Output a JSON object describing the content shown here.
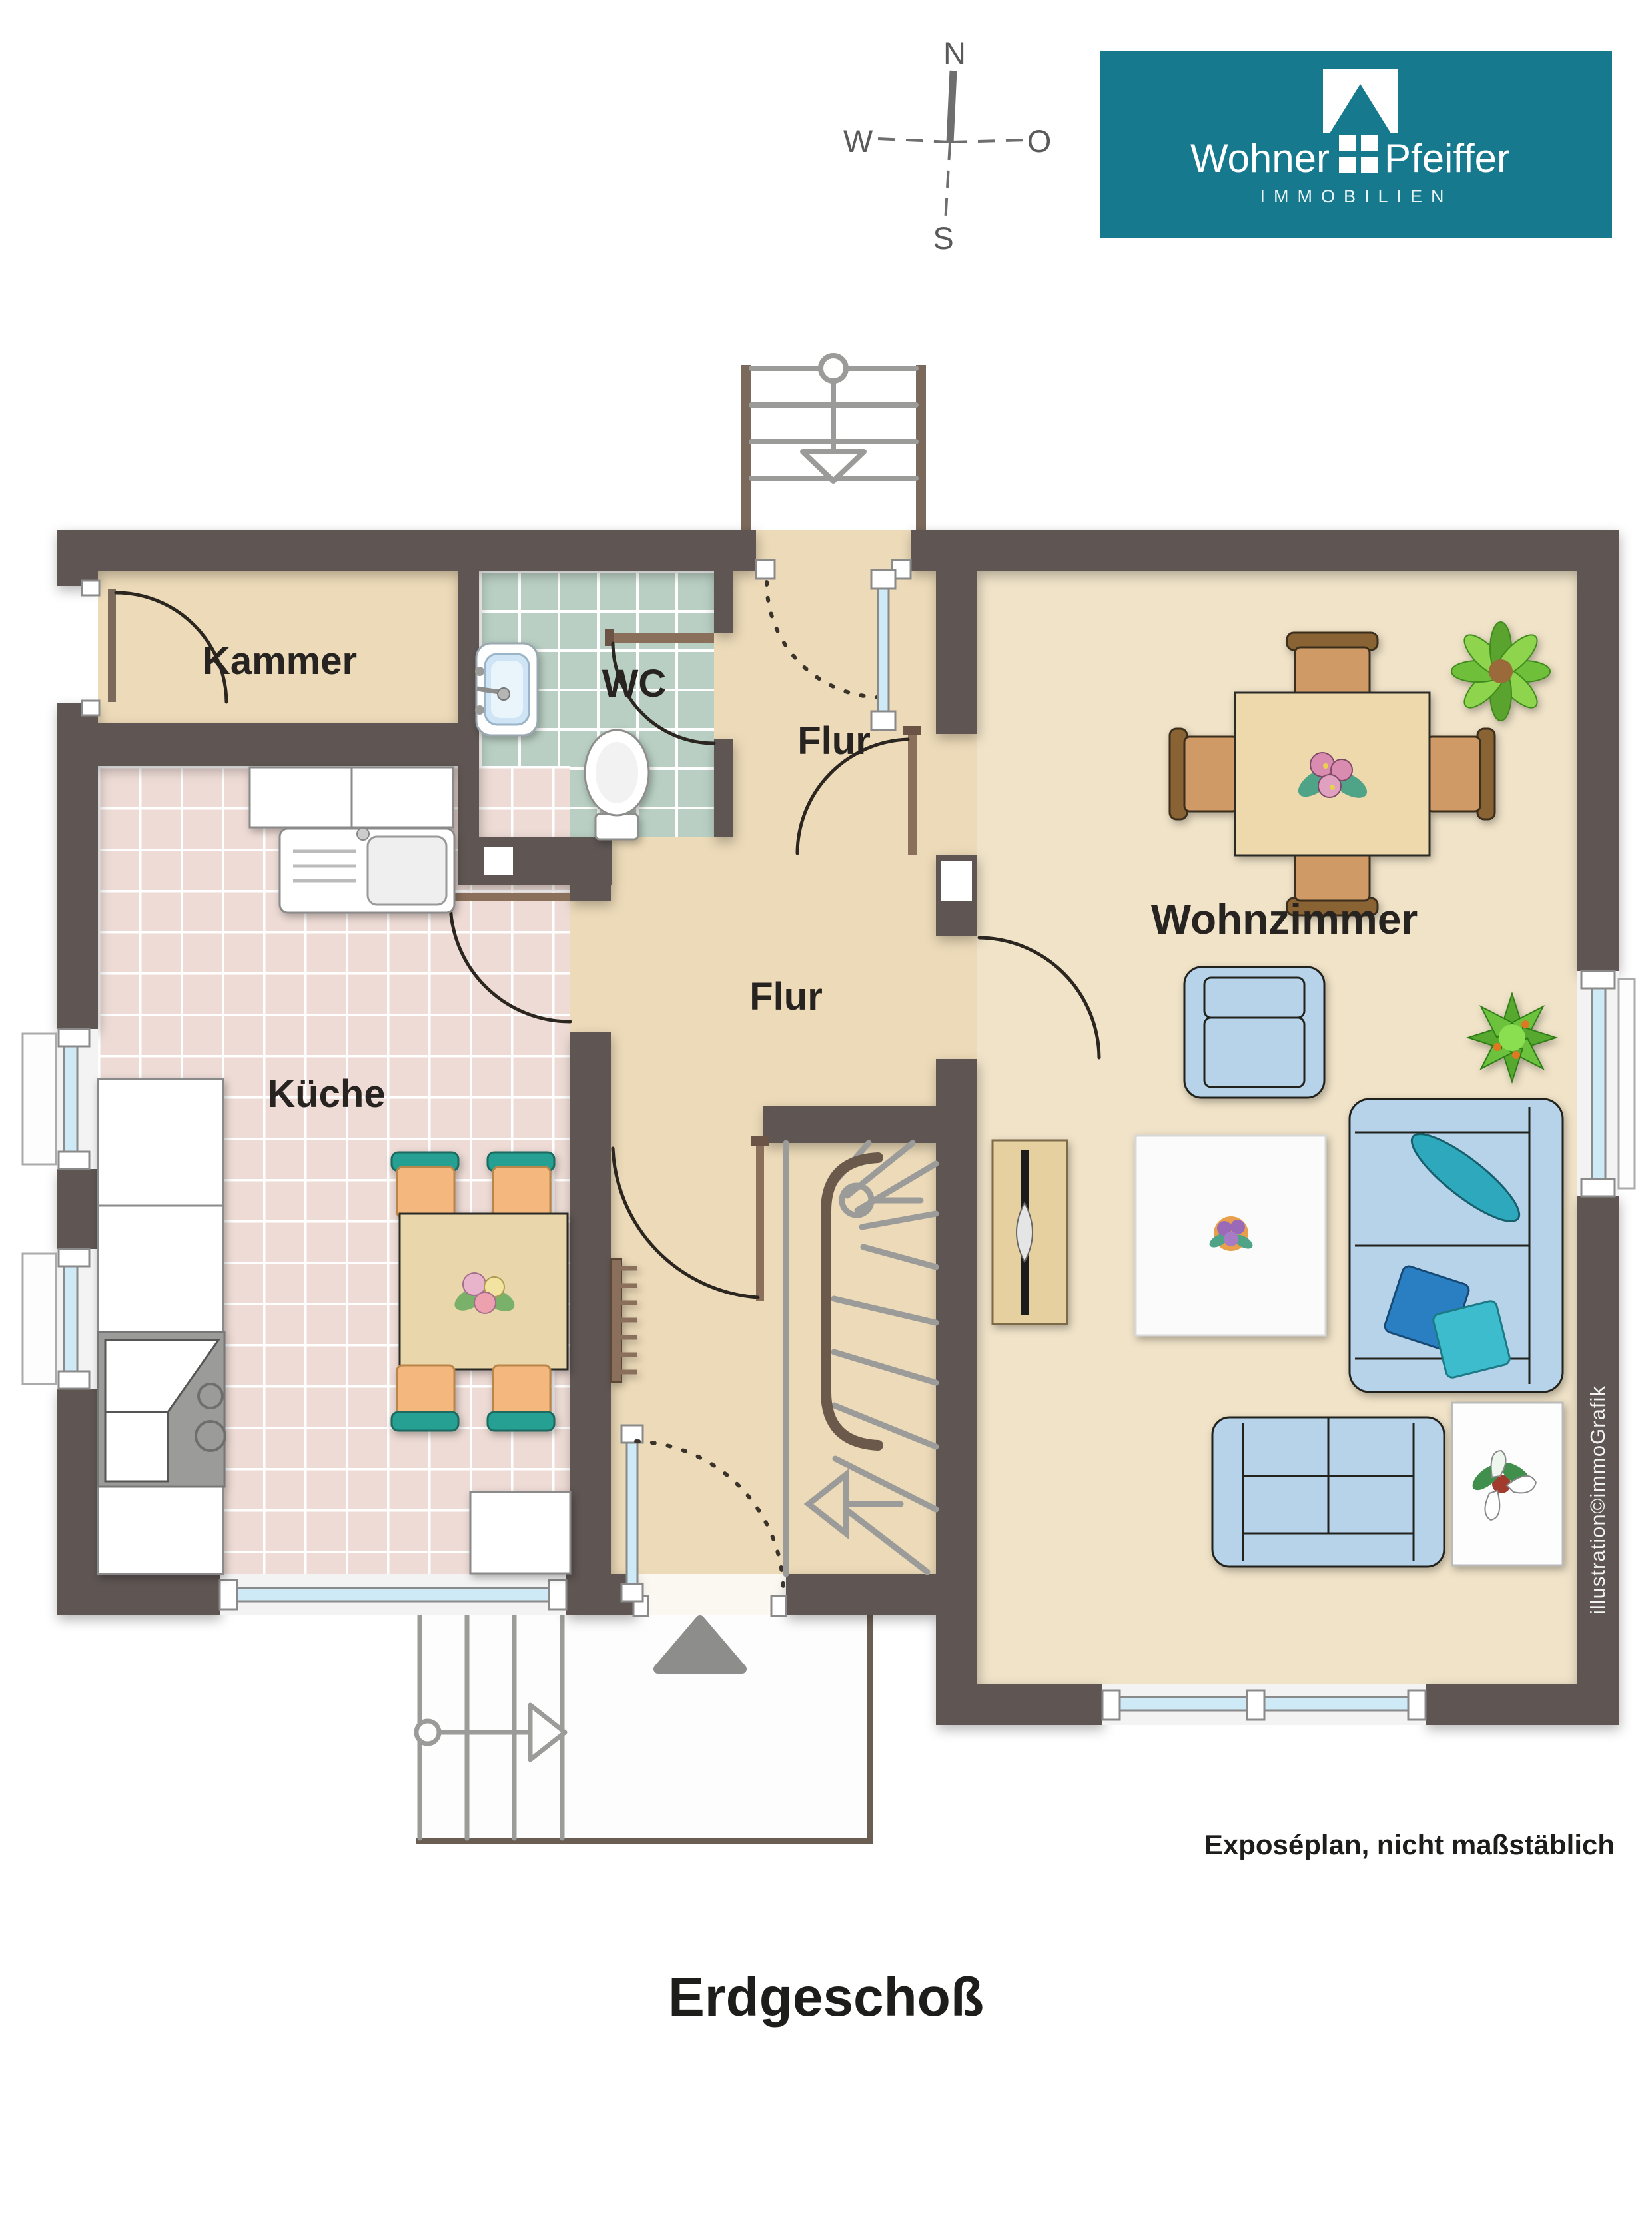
{
  "compass": {
    "north": "N",
    "south": "S",
    "west": "W",
    "east": "O"
  },
  "logo": {
    "name_first": "Wohner",
    "name_second": "Pfeiffer",
    "tagline": "IMMOBILIEN",
    "brand_color": "#17798e"
  },
  "plan": {
    "rooms": [
      {
        "id": "kammer",
        "label": "Kammer"
      },
      {
        "id": "wc",
        "label": "WC"
      },
      {
        "id": "flur-top",
        "label": "Flur"
      },
      {
        "id": "flur",
        "label": "Flur"
      },
      {
        "id": "kueche",
        "label": "Küche"
      },
      {
        "id": "wohnzimmer",
        "label": "Wohnzimmer"
      }
    ],
    "credit": "illustration©immoGrafik",
    "colors": {
      "wall": "#5e5752",
      "floor_hall": "#ecdab8",
      "floor_living": "#f0e3c8",
      "tile_kitchen": "#eedbd5",
      "tile_wc": "#b9cfc3",
      "window_glass": "#cdeaf6",
      "stair_gray": "#9b9b99",
      "door_wood": "#7b6a5b",
      "sofa_blue": "#b7d3ea",
      "chair_teal": "#27a093",
      "chair_orange": "#f4b87e"
    }
  },
  "footer": {
    "note": "Exposéplan, nicht maßstäblich",
    "title": "Erdgeschoß"
  }
}
